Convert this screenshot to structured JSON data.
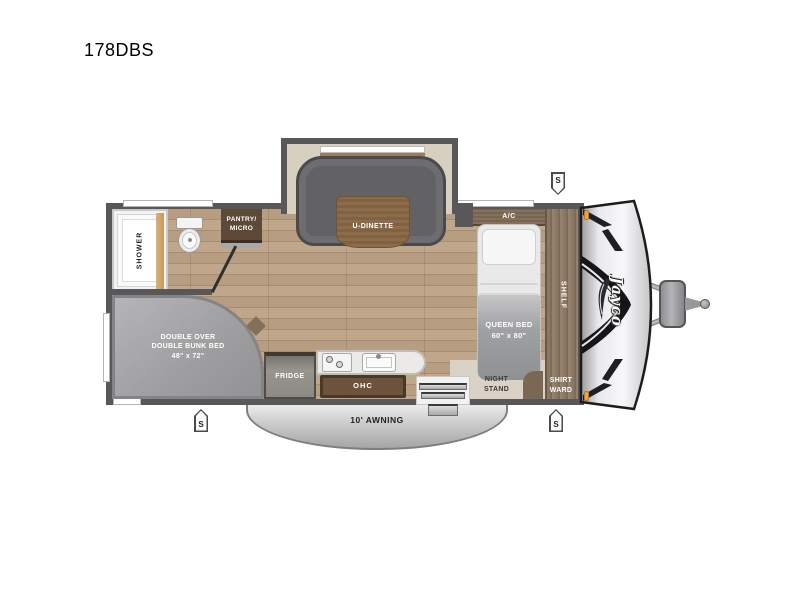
{
  "title": "178DBS",
  "brand": {
    "logo": "Jayco"
  },
  "rooms": {
    "shower": "SHOWER",
    "pantry": "PANTRY/\nMICRO",
    "dinette": "U-DINETTE",
    "ac": "A/C",
    "queen_bed": "QUEEN BED\n60\" x 80\"",
    "shelf": "SHELF",
    "night_stand": "NIGHT\nSTAND",
    "shirt_ward": "SHIRT\nWARD",
    "bunk": "DOUBLE OVER\nDOUBLE BUNK BED\n48\" x 72\"",
    "fridge": "FRIDGE",
    "ohc": "OHC",
    "awning": "10' AWNING"
  },
  "speakers": {
    "label": "S"
  },
  "colors": {
    "wall": "#59575a",
    "floor_wood": "#b79d81",
    "slide_floor": "#d7d0c1",
    "sofa_gray": "#626264",
    "table_wood": "#8a6a4c",
    "cabinet_wood": "#7c6753",
    "dark_cabinet": "#5d4938",
    "bunk_gray": "#a2a2a4",
    "mattress_white": "#e9e9e9",
    "blanket_gray": "#9fa0a2",
    "awning_gray": "#c9c9c9",
    "beige_floor": "#d9d2c3",
    "amber_light": "#f0a441"
  }
}
